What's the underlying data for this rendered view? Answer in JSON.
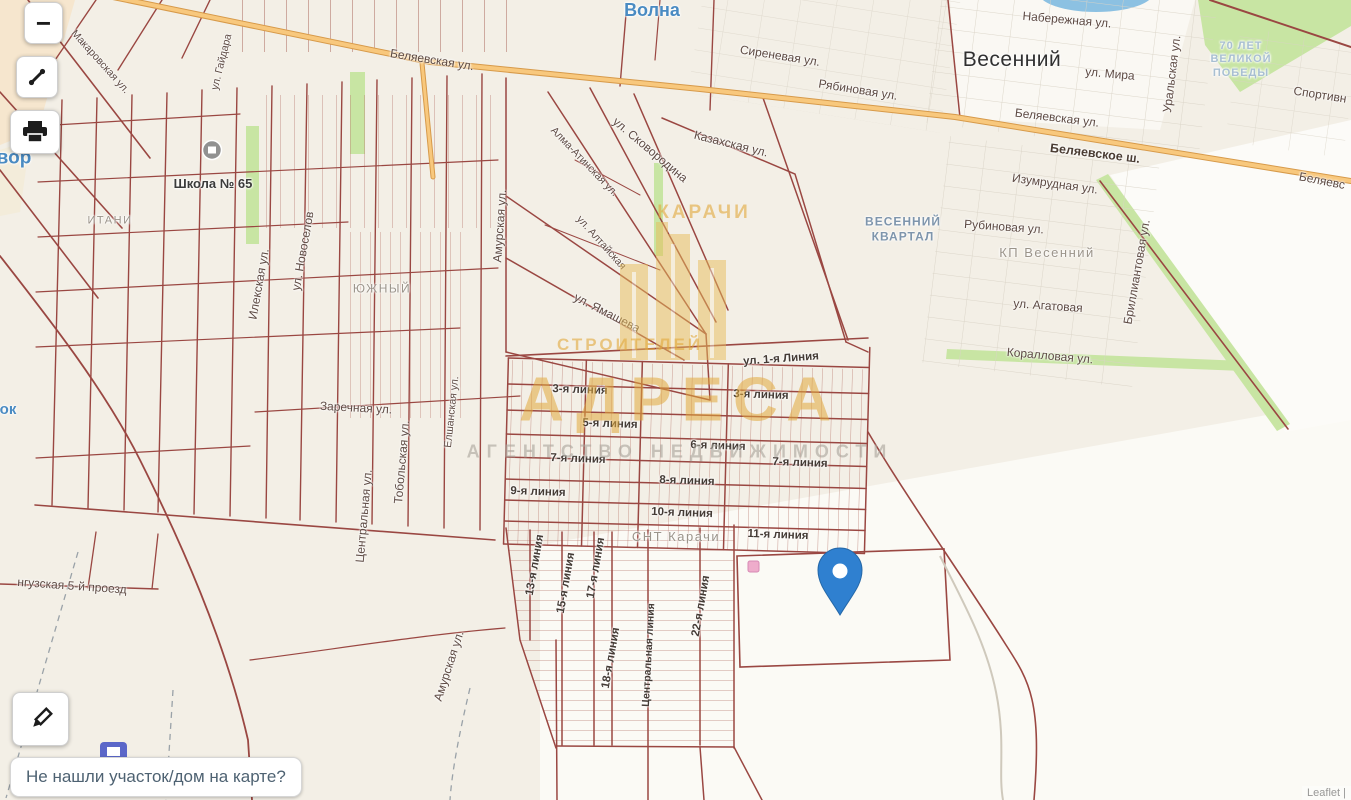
{
  "theme": {
    "pin": "#2f80d0",
    "watermark_gold": "#e2a93c",
    "parcel_line": "#9a4742",
    "highway_fill": "#f8c87d",
    "place_blue": "#4a8bc2",
    "map_background": "#f3efe6"
  },
  "controls": {
    "zoom_out_glyph": "−",
    "expand_icon": "expand-diagonal",
    "print_icon": "printer",
    "draw_icon": "pencil"
  },
  "prompt": {
    "text": "Не нашли участок/дом на карте?"
  },
  "attribution": "Leaflet |",
  "watermark": {
    "district_top": "КАРАЧИ",
    "district_left": "СТРОИТЕЛЕЙ",
    "brand": "АДРЕСА",
    "subtitle": "АГЕНТСТВО НЕДВИЖИМОСТИ"
  },
  "map": {
    "pin": {
      "x": 840,
      "y": 615
    },
    "labels": [
      {
        "text": "Волна",
        "x": 652,
        "y": 11,
        "cls": "place-blue"
      },
      {
        "text": "вор",
        "x": 14,
        "y": 158,
        "cls": "place-blue",
        "size": 19
      },
      {
        "text": "ок",
        "x": 8,
        "y": 410,
        "cls": "place-blue",
        "size": 15
      },
      {
        "text": "Весенний",
        "x": 1012,
        "y": 60,
        "cls": "place-town"
      },
      {
        "text": "ВЕСЕННИЙ\nКВАРТАЛ",
        "x": 903,
        "y": 229,
        "cls": "place-mblue"
      },
      {
        "text": "70 ЛЕТ\nВЕЛИКОЙ\nПОБЕДЫ",
        "x": 1241,
        "y": 60,
        "cls": "place-lblue"
      },
      {
        "text": "КП Весенний",
        "x": 1047,
        "y": 253,
        "cls": "place-gray"
      },
      {
        "text": "СНТ Карачи",
        "x": 676,
        "y": 537,
        "cls": "place-gray"
      },
      {
        "text": "ЮЖНЫЙ",
        "x": 382,
        "y": 289,
        "cls": "place-gray",
        "size": 12
      },
      {
        "text": "ИТАНИ",
        "x": 110,
        "y": 221,
        "cls": "place-gray",
        "size": 11
      },
      {
        "text": "Школа № 65",
        "x": 213,
        "y": 184,
        "cls": "poi"
      },
      {
        "text": "Беляевская ул.",
        "x": 432,
        "y": 60,
        "rot": 9
      },
      {
        "text": "Сиреневая ул.",
        "x": 780,
        "y": 56,
        "rot": 9
      },
      {
        "text": "Рябиновая ул.",
        "x": 858,
        "y": 90,
        "rot": 9
      },
      {
        "text": "Набережная ул.",
        "x": 1067,
        "y": 20,
        "rot": 5
      },
      {
        "text": "ул. Мира",
        "x": 1110,
        "y": 74,
        "rot": 5
      },
      {
        "text": "Уральская ул.",
        "x": 1172,
        "y": 74,
        "rot": -83
      },
      {
        "text": "Беляевская ул.",
        "x": 1057,
        "y": 118,
        "rot": 7
      },
      {
        "text": "Беляевское ш.",
        "x": 1095,
        "y": 154,
        "rot": 7,
        "cls": "street hw"
      },
      {
        "text": "Беляевс",
        "x": 1322,
        "y": 181,
        "rot": 11
      },
      {
        "text": "Спортивн",
        "x": 1320,
        "y": 95,
        "rot": 9
      },
      {
        "text": "Изумрудная ул.",
        "x": 1055,
        "y": 184,
        "rot": 8
      },
      {
        "text": "Рубиновая ул.",
        "x": 1004,
        "y": 227,
        "rot": 4
      },
      {
        "text": "ул. Агатовая",
        "x": 1048,
        "y": 306,
        "rot": 4
      },
      {
        "text": "Коралловая ул.",
        "x": 1050,
        "y": 356,
        "rot": 5
      },
      {
        "text": "Бриллиантовая ул.",
        "x": 1137,
        "y": 272,
        "rot": -80
      },
      {
        "text": "ул. Сковородина",
        "x": 650,
        "y": 150,
        "rot": 40
      },
      {
        "text": "Казахская ул.",
        "x": 731,
        "y": 144,
        "rot": 14
      },
      {
        "text": "Алма-Атинская ул.",
        "x": 584,
        "y": 162,
        "rot": 46,
        "size": 10.5
      },
      {
        "text": "ул. Алтайская",
        "x": 601,
        "y": 243,
        "rot": 48,
        "size": 10.5
      },
      {
        "text": "ул. Ямашева",
        "x": 607,
        "y": 313,
        "rot": 27
      },
      {
        "text": "Амурская ул.",
        "x": 500,
        "y": 226,
        "rot": -86
      },
      {
        "text": "Илекская ул.",
        "x": 259,
        "y": 284,
        "rot": -80
      },
      {
        "text": "ул. Новоселов",
        "x": 303,
        "y": 251,
        "rot": -80
      },
      {
        "text": "ул. Гайдара",
        "x": 222,
        "y": 62,
        "rot": -76,
        "size": 10.5
      },
      {
        "text": "Макаровская ул.",
        "x": 100,
        "y": 62,
        "rot": 48,
        "size": 10.5
      },
      {
        "text": "Тобольская ул.",
        "x": 402,
        "y": 462,
        "rot": -85
      },
      {
        "text": "Центральная ул.",
        "x": 364,
        "y": 516,
        "rot": -85
      },
      {
        "text": "Елшанская ул.",
        "x": 452,
        "y": 412,
        "rot": -84,
        "size": 10.5
      },
      {
        "text": "Заречная ул.",
        "x": 356,
        "y": 408,
        "rot": 3
      },
      {
        "text": "нгузская 5-й проезд",
        "x": 72,
        "y": 586,
        "rot": 4
      },
      {
        "text": "Амурская ул.",
        "x": 449,
        "y": 666,
        "rot": -72
      },
      {
        "text": "ул. 1-я Линия",
        "x": 781,
        "y": 359,
        "rot": -4,
        "cls": "linia"
      },
      {
        "text": "3-я линия",
        "x": 580,
        "y": 390,
        "rot": 2,
        "cls": "linia"
      },
      {
        "text": "3-я линия",
        "x": 761,
        "y": 395,
        "rot": 2,
        "cls": "linia"
      },
      {
        "text": "5-я линия",
        "x": 610,
        "y": 424,
        "rot": 2,
        "cls": "linia"
      },
      {
        "text": "6-я линия",
        "x": 718,
        "y": 446,
        "rot": 2,
        "cls": "linia"
      },
      {
        "text": "7-я линия",
        "x": 578,
        "y": 459,
        "rot": 2,
        "cls": "linia"
      },
      {
        "text": "7-я линия",
        "x": 800,
        "y": 463,
        "rot": 2,
        "cls": "linia"
      },
      {
        "text": "8-я линия",
        "x": 687,
        "y": 481,
        "rot": 2,
        "cls": "linia"
      },
      {
        "text": "9-я линия",
        "x": 538,
        "y": 492,
        "rot": 2,
        "cls": "linia"
      },
      {
        "text": "10-я линия",
        "x": 682,
        "y": 513,
        "rot": 2,
        "cls": "linia"
      },
      {
        "text": "11-я линия",
        "x": 778,
        "y": 535,
        "rot": 2,
        "cls": "linia"
      },
      {
        "text": "13-я линия",
        "x": 535,
        "y": 565,
        "rot": -80,
        "cls": "linia"
      },
      {
        "text": "15-я линия",
        "x": 566,
        "y": 583,
        "rot": -80,
        "cls": "linia"
      },
      {
        "text": "17-я линия",
        "x": 596,
        "y": 568,
        "rot": -80,
        "cls": "linia"
      },
      {
        "text": "18-я линия",
        "x": 611,
        "y": 658,
        "rot": -80,
        "cls": "linia"
      },
      {
        "text": "Центральная линия",
        "x": 649,
        "y": 655,
        "rot": -87,
        "cls": "linia",
        "size": 10.5
      },
      {
        "text": "22-я линия",
        "x": 701,
        "y": 606,
        "rot": -80,
        "cls": "linia"
      }
    ]
  }
}
